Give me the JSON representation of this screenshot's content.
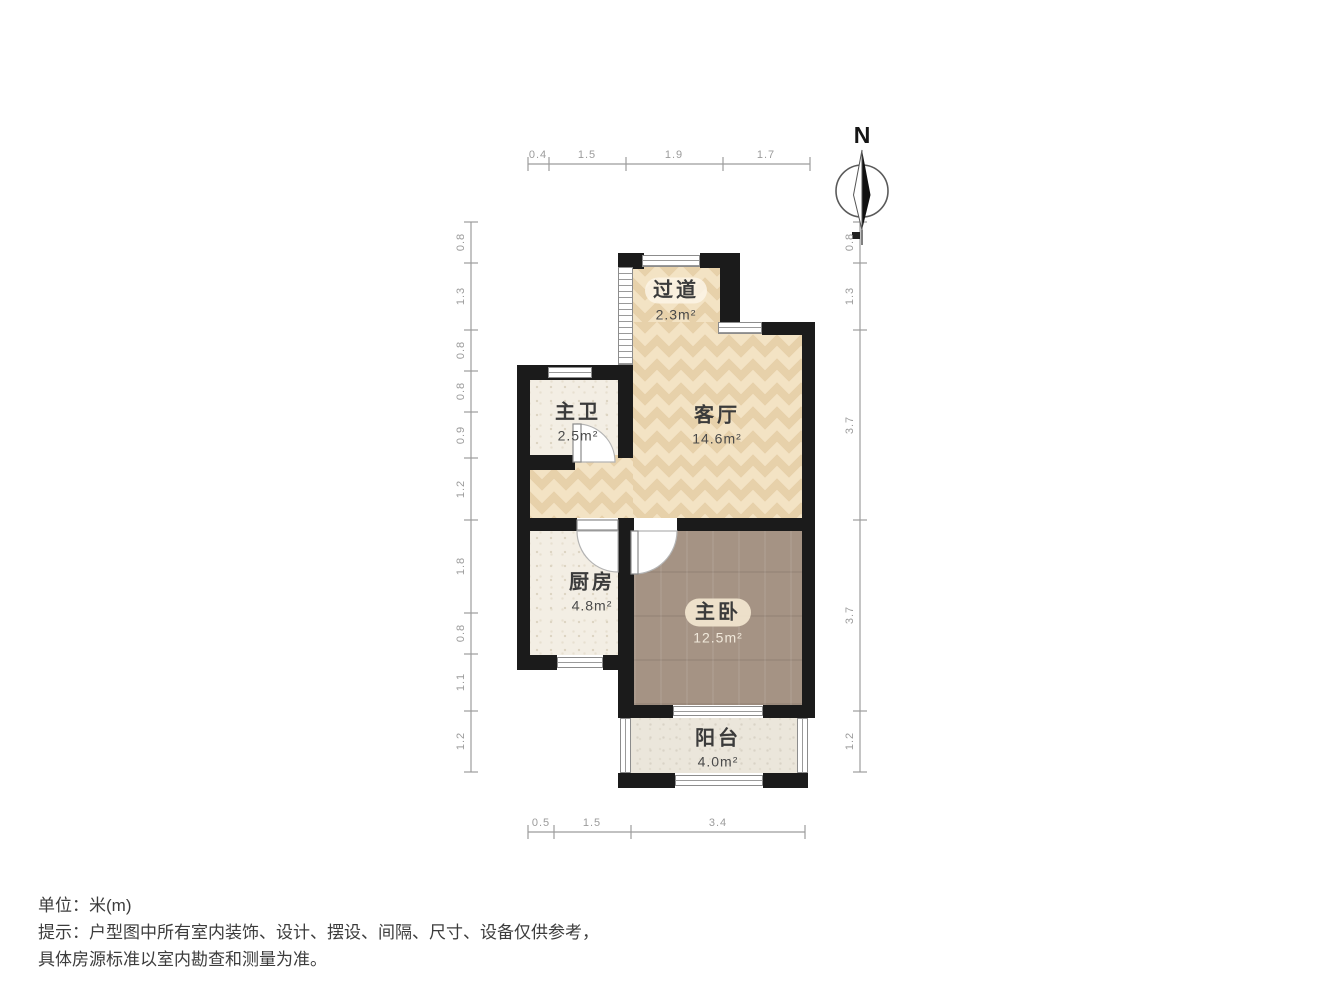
{
  "compass": {
    "label": "N"
  },
  "rooms": [
    {
      "name": "过道",
      "area": "2.3m²"
    },
    {
      "name": "主卫",
      "area": "2.5m²"
    },
    {
      "name": "客厅",
      "area": "14.6m²"
    },
    {
      "name": "厨房",
      "area": "4.8m²"
    },
    {
      "name": "主卧",
      "area": "12.5m²"
    },
    {
      "name": "阳台",
      "area": "4.0m²"
    }
  ],
  "dimensions": {
    "top": [
      "0.4",
      "1.5",
      "1.9",
      "1.7"
    ],
    "bottom": [
      "0.5",
      "1.5",
      "3.4"
    ],
    "left": [
      "0.8",
      "1.3",
      "0.8",
      "0.8",
      "0.9",
      "1.2",
      "1.8",
      "0.8",
      "1.1",
      "1.2"
    ],
    "right": [
      "0.8",
      "1.3",
      "3.7",
      "3.7",
      "1.2"
    ]
  },
  "footer": {
    "unit": "单位：米(m)",
    "tip_line1": "提示：户型图中所有室内装饰、设计、摆设、间隔、尺寸、设备仅供参考，",
    "tip_line2": "具体房源标准以室内勘查和测量为准。"
  },
  "colors": {
    "wall": "#1b1b1b",
    "living_floor": "#f3e3c4",
    "bedroom_floor": "#a59384",
    "tile_floor": "#f3eee4",
    "balcony_floor": "#ebe6db",
    "dimension_text": "#9b9b9b",
    "label_text": "#3b3b3b"
  }
}
